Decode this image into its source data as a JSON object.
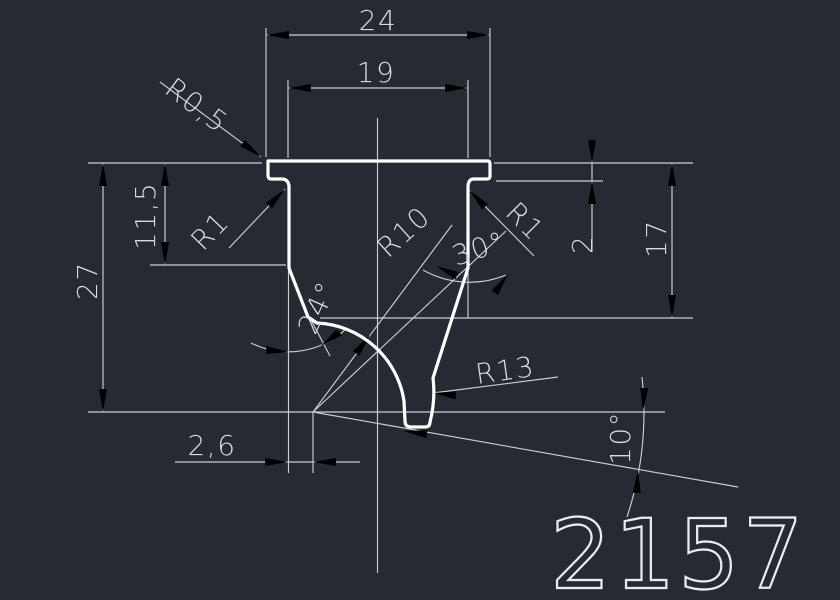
{
  "drawing": {
    "part_number": "2157",
    "colors": {
      "background": "#262a32",
      "profile_line": "#ffffff",
      "dimension_line": "#c9ced5",
      "text": "#d6dade"
    },
    "labels": {
      "dim_width_outer": "24",
      "dim_width_inner": "19",
      "radius_top_corner": "R0,5",
      "radius_fillet_left": "R1",
      "radius_fillet_right": "R1",
      "dim_depth_left": "11,5",
      "dim_height_total": "27",
      "dim_lip_height": "2",
      "dim_depth_right": "17",
      "angle_right_wall": "30°",
      "angle_left_wall": "24°",
      "radius_flank": "R10",
      "radius_tip": "R13",
      "dim_tip_offset": "2,6",
      "angle_tip": "10°"
    }
  }
}
